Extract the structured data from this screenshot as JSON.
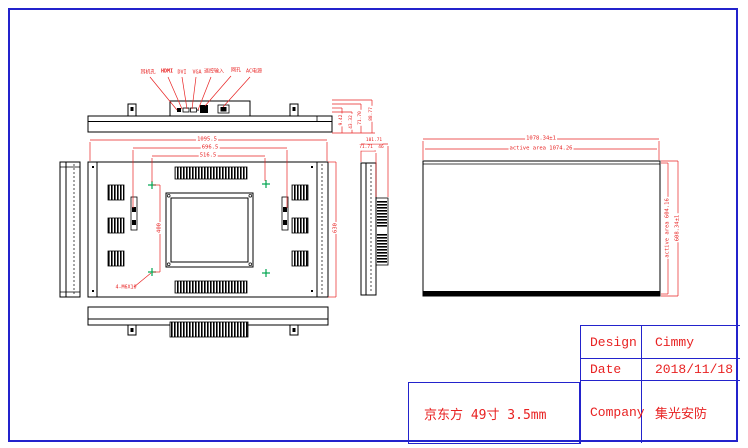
{
  "colors": {
    "drawing_line": "#000000",
    "dimension_red": "#e82222",
    "border_blue": "#2323cc",
    "vesa_green": "#00a550"
  },
  "note_box": {
    "text": "京东方 49寸 3.5mm"
  },
  "title_block": {
    "design_label": "Design",
    "design_value": "Cimmy",
    "date_label": "Date",
    "date_value": "2018/11/18",
    "company_label": "Company",
    "company_value": "集光安防"
  },
  "connector_labels": {
    "c1": "耳机孔",
    "c2": "HDMI",
    "c3": "DVI",
    "c4": "VGA",
    "c5": "遥控输入",
    "c6": "网孔",
    "c7": "AC电源"
  },
  "rear_dims": {
    "total_width": "1095.5",
    "handle_span": "696.5",
    "vesa_span": "516.5",
    "vesa_height": "400",
    "total_height": "630",
    "vesa_note": "4-M6X10"
  },
  "depth_dims": {
    "d1": "9.42",
    "d2": "43.32",
    "d3": "71.70",
    "d4": "88.77"
  },
  "side_dims": {
    "s1": "101.71",
    "s2": "71.71",
    "s3": "46"
  },
  "screen_dims": {
    "outline_width": "1078.34±1",
    "active_width": "active area 1074.26",
    "active_height": "active area 604.16",
    "outline_height": "608.34±1"
  }
}
